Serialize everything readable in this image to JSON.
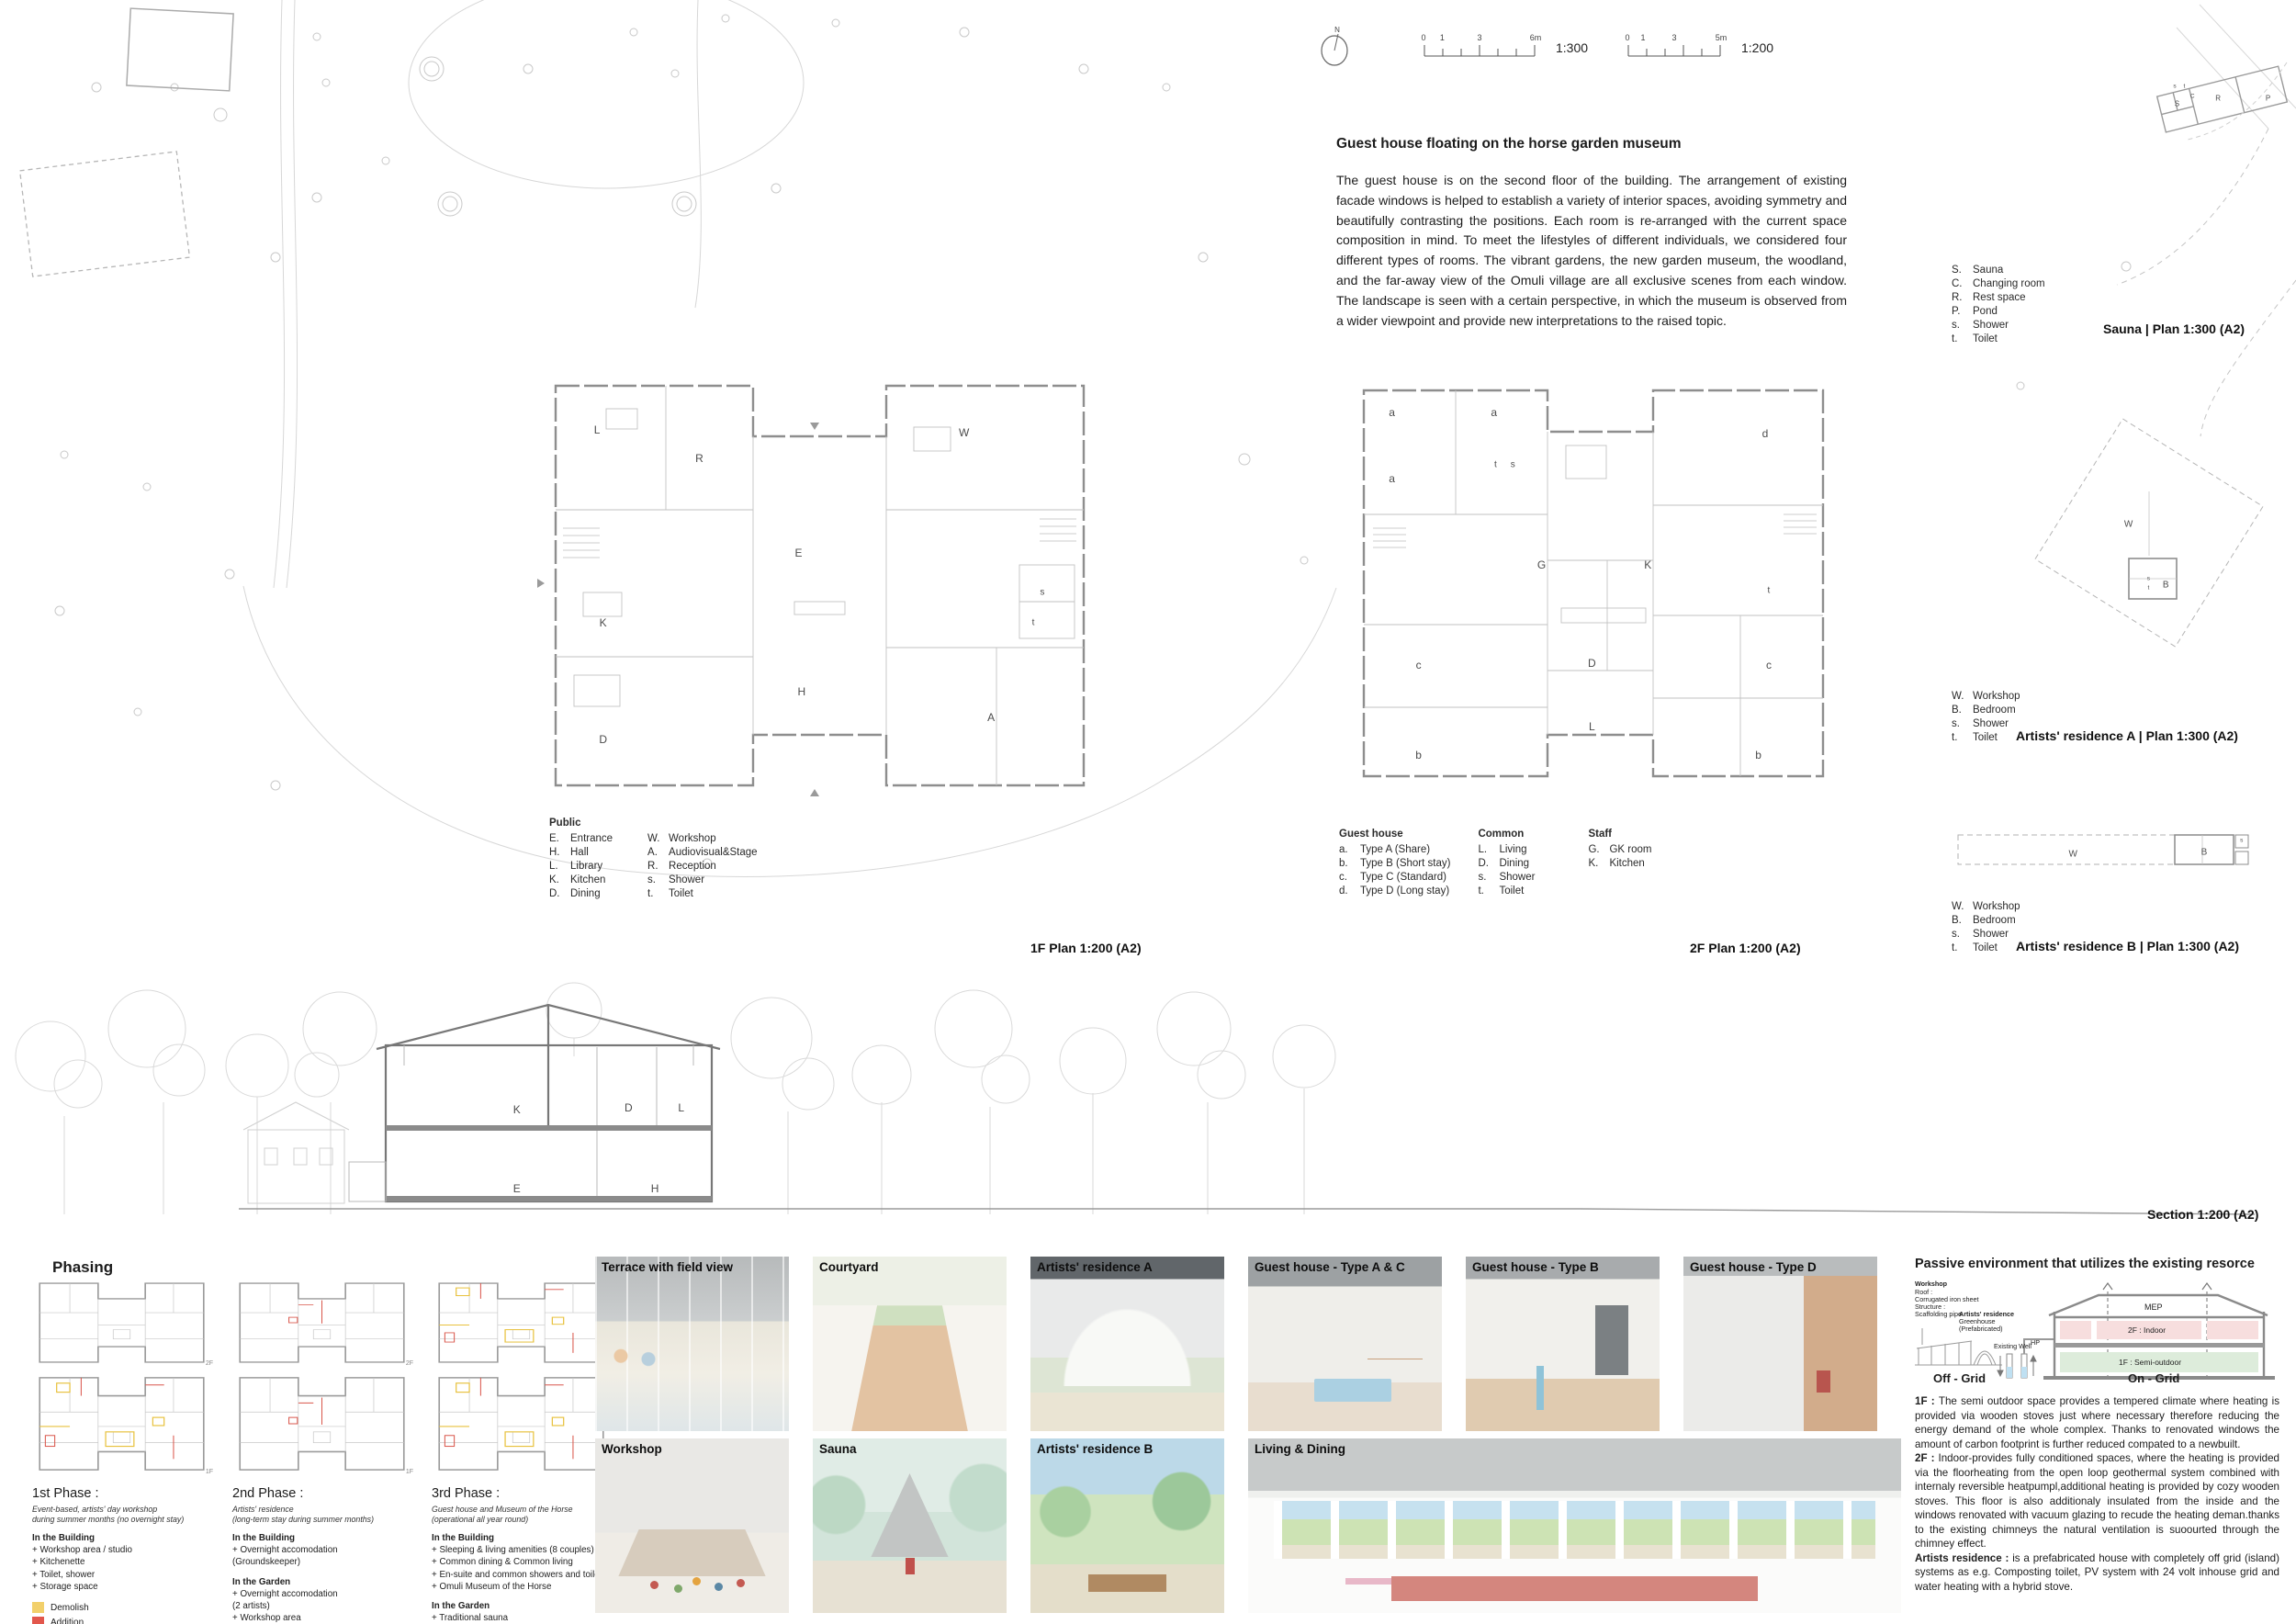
{
  "header": {
    "north_label": "N",
    "scalebar_300": {
      "nums": [
        "0",
        "1",
        "3",
        "6m"
      ],
      "ratio": "1:300"
    },
    "scalebar_200": {
      "nums": [
        "0",
        "1",
        "3",
        "5m"
      ],
      "ratio": "1:200"
    }
  },
  "intro": {
    "title": "Guest house floating on the horse garden museum",
    "body": "The guest house is on the second floor of the building. The arrangement of existing facade windows is helped to establish a variety of interior spaces, avoiding symmetry and beautifully contrasting the positions. Each room is re-arranged with the current space composition in mind. To meet the lifestyles of different individuals, we considered four different types of rooms. The vibrant gardens, the new garden museum, the woodland, and the far-away view of the Omuli village are all exclusive scenes from each window. The landscape is seen with a certain perspective, in which the museum is observed from a wider viewpoint and provide new interpretations to the raised topic."
  },
  "plans": {
    "plan_1f": {
      "label": "1F Plan 1:200 (A2)",
      "legend_title": "Public",
      "legend_col1": [
        [
          "E.",
          "Entrance"
        ],
        [
          "H.",
          "Hall"
        ],
        [
          "L.",
          "Library"
        ],
        [
          "K.",
          "Kitchen"
        ],
        [
          "D.",
          "Dining"
        ]
      ],
      "legend_col2": [
        [
          "W.",
          "Workshop"
        ],
        [
          "A.",
          "Audiovisual&Stage"
        ],
        [
          "R.",
          "Reception"
        ],
        [
          "s.",
          "Shower"
        ],
        [
          "t.",
          "Toilet"
        ]
      ],
      "letters": [
        {
          "t": "L",
          "x": 13,
          "y": 13.5
        },
        {
          "t": "R",
          "x": 30,
          "y": 20
        },
        {
          "t": "W",
          "x": 74,
          "y": 14
        },
        {
          "t": "E",
          "x": 46.5,
          "y": 42
        },
        {
          "t": "K",
          "x": 14,
          "y": 58
        },
        {
          "t": "s",
          "x": 87,
          "y": 51,
          "fs": 10
        },
        {
          "t": "t",
          "x": 85.5,
          "y": 58,
          "fs": 10
        },
        {
          "t": "H",
          "x": 47,
          "y": 74
        },
        {
          "t": "A",
          "x": 78.5,
          "y": 80
        },
        {
          "t": "D",
          "x": 14,
          "y": 85
        }
      ]
    },
    "plan_2f": {
      "label": "2F Plan 1:200 (A2)",
      "groups": [
        {
          "title": "Guest house",
          "items": [
            [
              "a.",
              "Type A (Share)"
            ],
            [
              "b.",
              "Type B (Short stay)"
            ],
            [
              "c.",
              "Type C (Standard)"
            ],
            [
              "d.",
              "Type D (Long stay)"
            ]
          ]
        },
        {
          "title": "Common",
          "items": [
            [
              "L.",
              "Living"
            ],
            [
              "D.",
              "Dining"
            ],
            [
              "s.",
              "Shower"
            ],
            [
              "t.",
              "Toilet"
            ]
          ]
        },
        {
          "title": "Staff",
          "items": [
            [
              "G.",
              "GK room"
            ],
            [
              "K.",
              "Kitchen"
            ]
          ]
        }
      ],
      "letters": [
        {
          "t": "a",
          "x": 11.5,
          "y": 8.7
        },
        {
          "t": "a",
          "x": 31,
          "y": 8.7
        },
        {
          "t": "a",
          "x": 11.5,
          "y": 24.6
        },
        {
          "t": "t",
          "x": 31.3,
          "y": 21.4,
          "fs": 10
        },
        {
          "t": "s",
          "x": 34.6,
          "y": 21.4,
          "fs": 10
        },
        {
          "t": "d",
          "x": 82.8,
          "y": 13.8
        },
        {
          "t": "G",
          "x": 40.1,
          "y": 45.5
        },
        {
          "t": "K",
          "x": 60.4,
          "y": 45.5
        },
        {
          "t": "t",
          "x": 83.5,
          "y": 51.7,
          "fs": 10
        },
        {
          "t": "c",
          "x": 16.6,
          "y": 69.7
        },
        {
          "t": "c",
          "x": 83.5,
          "y": 69.7
        },
        {
          "t": "D",
          "x": 49.7,
          "y": 69.4
        },
        {
          "t": "L",
          "x": 49.7,
          "y": 84.6
        },
        {
          "t": "b",
          "x": 16.6,
          "y": 91.5
        },
        {
          "t": "b",
          "x": 81.5,
          "y": 91.5
        }
      ]
    },
    "sauna": {
      "label": "Sauna | Plan 1:300 (A2)",
      "legend": [
        [
          "S.",
          "Sauna"
        ],
        [
          "C.",
          "Changing room"
        ],
        [
          "R.",
          "Rest space"
        ],
        [
          "P.",
          "Pond"
        ],
        [
          "s.",
          "Shower"
        ],
        [
          "t.",
          "Toilet"
        ]
      ],
      "letters": [
        {
          "t": "s",
          "x": 17.5,
          "y": 40,
          "fs": 6.5
        },
        {
          "t": "t",
          "x": 24,
          "y": 40,
          "fs": 6.5
        },
        {
          "t": "S",
          "x": 19,
          "y": 57,
          "fs": 8
        },
        {
          "t": "C",
          "x": 29.5,
          "y": 50,
          "fs": 6.5
        },
        {
          "t": "R",
          "x": 47,
          "y": 52,
          "fs": 8
        },
        {
          "t": "P",
          "x": 81,
          "y": 52,
          "fs": 8
        }
      ]
    },
    "residence_a": {
      "label": "Artists' residence A | Plan 1:300 (A2)",
      "legend": [
        [
          "W.",
          "Workshop"
        ],
        [
          "B.",
          "Bedroom"
        ],
        [
          "s.",
          "Shower"
        ],
        [
          "t.",
          "Toilet"
        ]
      ],
      "letters": [
        {
          "t": "W",
          "x": 44,
          "y": 47,
          "fs": 10
        },
        {
          "t": "B",
          "x": 58,
          "y": 69,
          "fs": 10
        },
        {
          "t": "s",
          "x": 51.5,
          "y": 66.5,
          "fs": 6.5
        },
        {
          "t": "t",
          "x": 51.5,
          "y": 70,
          "fs": 6.5
        }
      ]
    },
    "residence_b": {
      "label": "Artists' residence B | Plan 1:300 (A2)",
      "legend": [
        [
          "W.",
          "Workshop"
        ],
        [
          "B.",
          "Bedroom"
        ],
        [
          "s.",
          "Shower"
        ],
        [
          "t.",
          "Toilet"
        ]
      ],
      "letters": [
        {
          "t": "W",
          "x": 38,
          "y": 58,
          "fs": 10
        },
        {
          "t": "B",
          "x": 80,
          "y": 55,
          "fs": 10
        },
        {
          "t": "s",
          "x": 92,
          "y": 34,
          "fs": 6.5
        }
      ]
    },
    "section": {
      "label": "Section 1:200 (A2)",
      "letters": [
        {
          "t": "K",
          "x": 13.7,
          "y": 51
        },
        {
          "t": "D",
          "x": 19.2,
          "y": 50.4
        },
        {
          "t": "L",
          "x": 21.8,
          "y": 50.4
        },
        {
          "t": "E",
          "x": 13.7,
          "y": 85.5
        },
        {
          "t": "H",
          "x": 20.5,
          "y": 85.5
        }
      ]
    }
  },
  "phasing": {
    "title": "Phasing",
    "floor_labels": [
      "2F",
      "1F"
    ],
    "legend": [
      {
        "label": "Demolish",
        "color": "#f2d06b"
      },
      {
        "label": "Addition",
        "color": "#e2574c"
      }
    ],
    "phases": [
      {
        "name": "1st Phase :",
        "subtitle": [
          "Event-based, artists' day workshop",
          "during summer months (no overnight stay)"
        ],
        "sections": [
          {
            "title": "In the Building",
            "items": [
              "+ Workshop area / studio",
              "+ Kitchenette",
              "+ Toilet, shower",
              "+ Storage space"
            ]
          }
        ],
        "show_legend": true
      },
      {
        "name": "2nd Phase :",
        "subtitle": [
          "Artists' residence",
          "(long-term stay during summer months)"
        ],
        "sections": [
          {
            "title": "In the Building",
            "items": [
              "+ Overnight accomodation",
              "   (Groundskeeper)"
            ]
          },
          {
            "title": "In the Garden",
            "items": [
              "+ Overnight accomodation",
              "   (2 artists)",
              "+ Workshop area",
              "+ Toilet, shower"
            ]
          }
        ],
        "show_legend": false
      },
      {
        "name": "3rd Phase :",
        "subtitle": [
          "Guest house and Museum of the Horse",
          "(operational all year round)"
        ],
        "sections": [
          {
            "title": "In the Building",
            "items": [
              "+ Sleeping & living amenities (8 couples)",
              "+ Common dining & Common living",
              "+ En-suite and common showers and toilets",
              "+ Omuli Museum of the Horse"
            ]
          },
          {
            "title": "In the Garden",
            "items": [
              "+ Traditional sauna",
              "+ Omuli Museum of the Horse"
            ]
          }
        ],
        "show_legend": false
      }
    ]
  },
  "gallery": {
    "row1": [
      "Terrace with field view",
      "Courtyard",
      "Artists' residence A",
      "Guest house - Type A & C",
      "Guest house - Type B",
      "Guest house - Type D"
    ],
    "row2": [
      "Workshop",
      "Sauna",
      "Artists' residence B",
      "Living & Dining"
    ]
  },
  "passive": {
    "title": "Passive environment that utilizes the existing resorce",
    "diagram": {
      "workshop_label": "Workshop",
      "workshop_lines": [
        "Roof :",
        "Corrugated iron sheet",
        "Structure :",
        "Scaffolding pipe"
      ],
      "residence_label": "Artists' residence",
      "residence_lines": [
        "Greenhouse",
        "(Prefabricated)"
      ],
      "well_label": "Existing Well",
      "hp_label": "HP",
      "mep_label": "MEP",
      "floor2_label": "2F : Indoor",
      "floor1_label": "1F : Semi-outdoor",
      "off_grid": "Off - Grid",
      "on_grid": "On - Grid",
      "indoor_color": "#f7dede",
      "semi_outdoor_color": "#ddecdb",
      "well_water_color": "#bfe0f2"
    },
    "paragraphs": [
      {
        "lead": "1F :",
        "text": "The semi outdoor space provides a tempered climate where heating is provided via wooden stoves just where necessary therefore reducing the energy demand of the whole complex. Thanks to renovated windows the amount of carbon footprint is further reduced compated to a newbuilt."
      },
      {
        "lead": "2F :",
        "text": "Indoor-provides fully conditioned spaces, where the heating is provided via the floorheating from the open loop geothermal system combined with internaly reversible heatpumpl,additional heating is provided by cozy wooden stoves. This floor is also additionaly insulated from the inside and the windows renovated with vacuum glazing to recude the heating deman.thanks to the existing chimneys the natural ventilation is suoourted through the chimney effect."
      },
      {
        "lead": "Artists residence :",
        "text": "is a prefabricated house with completely off grid (island) systems as e.g. Composting toilet, PV system with 24 volt inhouse grid and water heating with a hybrid stove."
      }
    ]
  }
}
